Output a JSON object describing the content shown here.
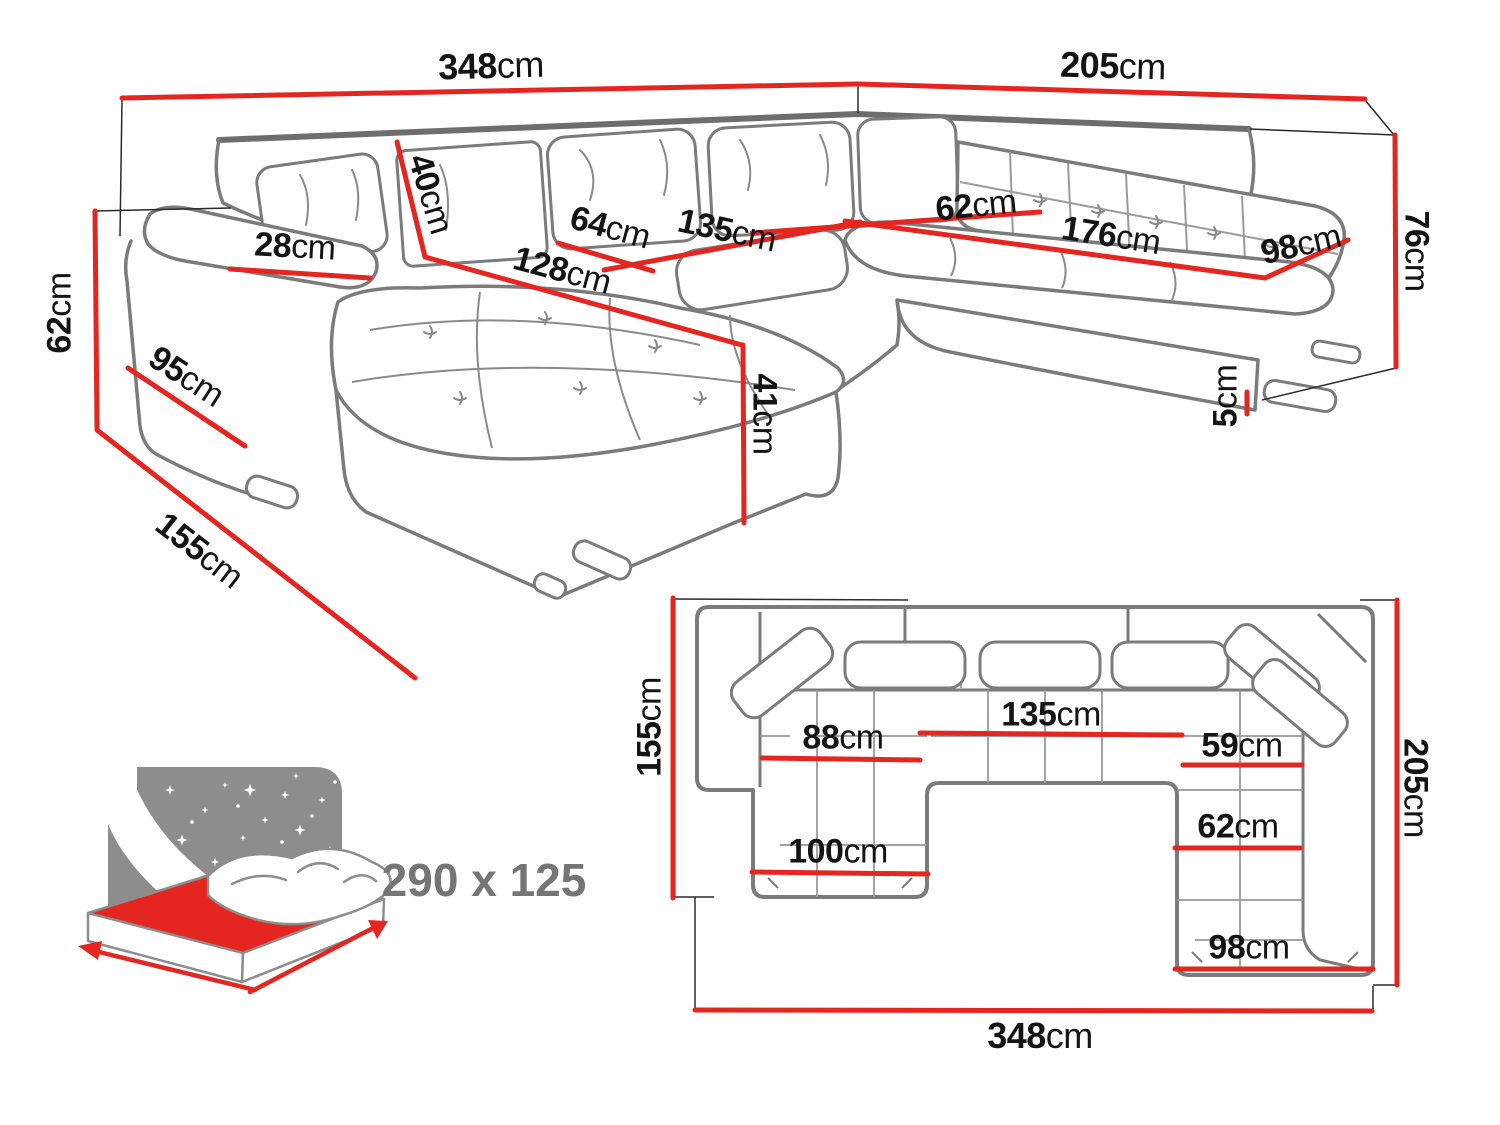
{
  "diagram_title": "U-shaped corner sofa dimensions",
  "colors": {
    "dimension_line": "#e52620",
    "sofa_outline": "#7b7b7b",
    "extension_line": "#2a2a2a",
    "label_text": "#141414",
    "sleeping_text": "#757575",
    "icon_gray": "#8d8d8d"
  },
  "views": {
    "perspective": {
      "name": "3D perspective view",
      "dimensions": [
        {
          "id": "total-width-left",
          "value": "348",
          "unit": "cm"
        },
        {
          "id": "total-depth-right",
          "value": "205",
          "unit": "cm"
        },
        {
          "id": "arm-height",
          "value": "62",
          "unit": "cm"
        },
        {
          "id": "chaise-side-depth",
          "value": "155",
          "unit": "cm"
        },
        {
          "id": "arm-side-length",
          "value": "95",
          "unit": "cm"
        },
        {
          "id": "arm-top-width",
          "value": "28",
          "unit": "cm"
        },
        {
          "id": "back-cushion-height",
          "value": "40",
          "unit": "cm"
        },
        {
          "id": "chaise-length",
          "value": "128",
          "unit": "cm"
        },
        {
          "id": "seat-depth-left",
          "value": "64",
          "unit": "cm"
        },
        {
          "id": "middle-seat-width",
          "value": "135",
          "unit": "cm"
        },
        {
          "id": "seat-depth-right",
          "value": "62",
          "unit": "cm"
        },
        {
          "id": "right-seat-length",
          "value": "176",
          "unit": "cm"
        },
        {
          "id": "right-end-width",
          "value": "98",
          "unit": "cm"
        },
        {
          "id": "back-height",
          "value": "76",
          "unit": "cm"
        },
        {
          "id": "seat-height",
          "value": "41",
          "unit": "cm"
        },
        {
          "id": "foot-height",
          "value": "5",
          "unit": "cm"
        }
      ]
    },
    "plan": {
      "name": "Top (plan) view",
      "dimensions": [
        {
          "id": "chaise-side-depth",
          "value": "155",
          "unit": "cm"
        },
        {
          "id": "left-seat-width",
          "value": "88",
          "unit": "cm"
        },
        {
          "id": "middle-seat-width",
          "value": "135",
          "unit": "cm"
        },
        {
          "id": "chaise-width",
          "value": "100",
          "unit": "cm"
        },
        {
          "id": "right-seat-width",
          "value": "59",
          "unit": "cm"
        },
        {
          "id": "right-seat-depth",
          "value": "62",
          "unit": "cm"
        },
        {
          "id": "right-end-width",
          "value": "98",
          "unit": "cm"
        },
        {
          "id": "right-side-depth",
          "value": "205",
          "unit": "cm"
        },
        {
          "id": "total-width",
          "value": "348",
          "unit": "cm"
        }
      ]
    },
    "sleeping": {
      "name": "Sleeping area",
      "value": "290 x 125"
    }
  }
}
